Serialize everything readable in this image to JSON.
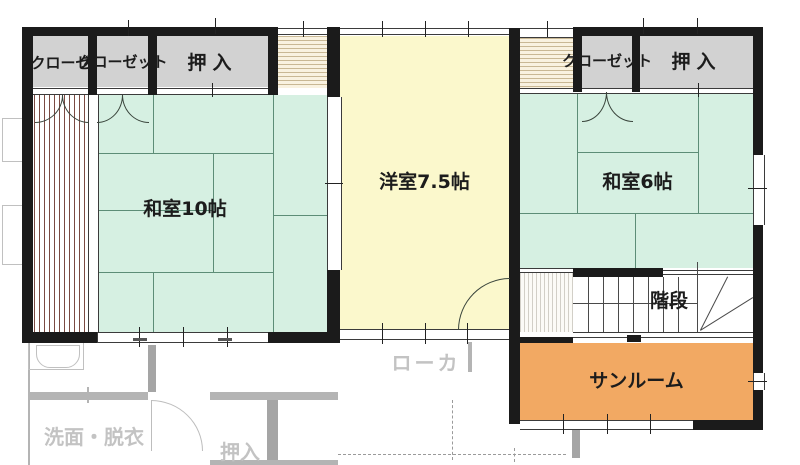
{
  "plan": {
    "rooms": {
      "washitsu10": "和室10帖",
      "yoshitsu75": "洋室7.5帖",
      "washitsu6": "和室6帖",
      "sunroom": "サンルーム",
      "stairs": "階段"
    },
    "storage": {
      "kuroze": "クローゼ",
      "kurozetto_left": "クローゼット",
      "oshiire_left": "押入",
      "kurozetto_right": "クローゼット",
      "oshiire_right": "押入"
    },
    "lower_floor": {
      "senmen_datsui": "洗面・脱衣",
      "oshiire": "押入",
      "roka": "ローカ"
    },
    "colors": {
      "tatami_room": "#d6f0e2",
      "western_room": "#fbf8cc",
      "sunroom": "#f2a963",
      "closet": "#d2d2d2",
      "wall": "#1b1b1b",
      "tatami_line": "#5d8d77",
      "veranda_stripe": "#7b4a42",
      "ghost": "#bdbdbd"
    }
  }
}
